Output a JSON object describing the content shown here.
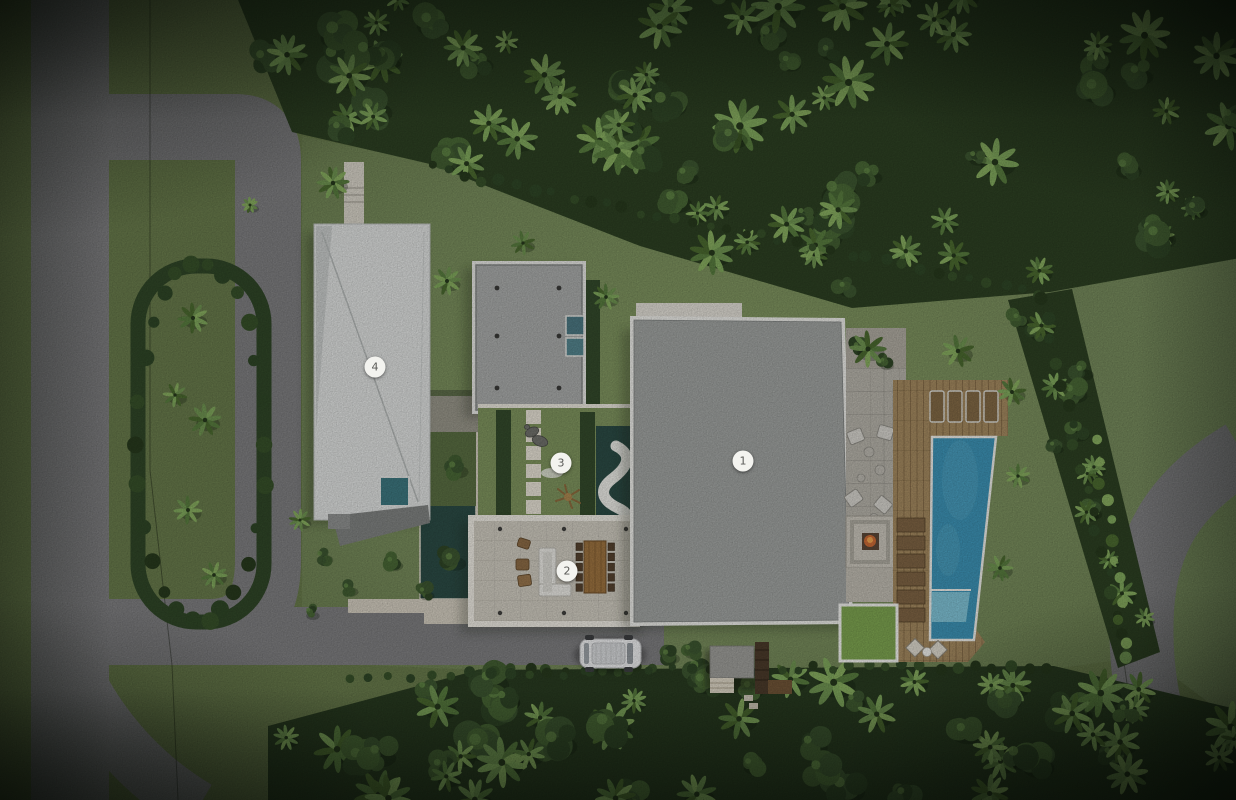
{
  "plan": {
    "type": "architectural-site-plan-top-view",
    "markers": [
      {
        "label": "1",
        "x": 743,
        "y": 461
      },
      {
        "label": "2",
        "x": 567,
        "y": 571
      },
      {
        "label": "3",
        "x": 561,
        "y": 463
      },
      {
        "label": "4",
        "x": 375,
        "y": 367
      }
    ],
    "colors": {
      "lawn": "#75895a",
      "jungle_dark": "#2c3f22",
      "road": "#7c7c7e",
      "pool_blue": "#3c90b2",
      "pool_shallow": "#7dbfd2",
      "pond_teal": "#2b4a44",
      "deck_wood": "#a1875e",
      "roof_main": "#9da09e",
      "roof_pavilion": "#a6a8a7",
      "roof_side_building": "#d8dad9",
      "stone_floor": "#cbc7bc",
      "fire": "#c96a35",
      "marker_bg": "#f3f3ef"
    }
  }
}
